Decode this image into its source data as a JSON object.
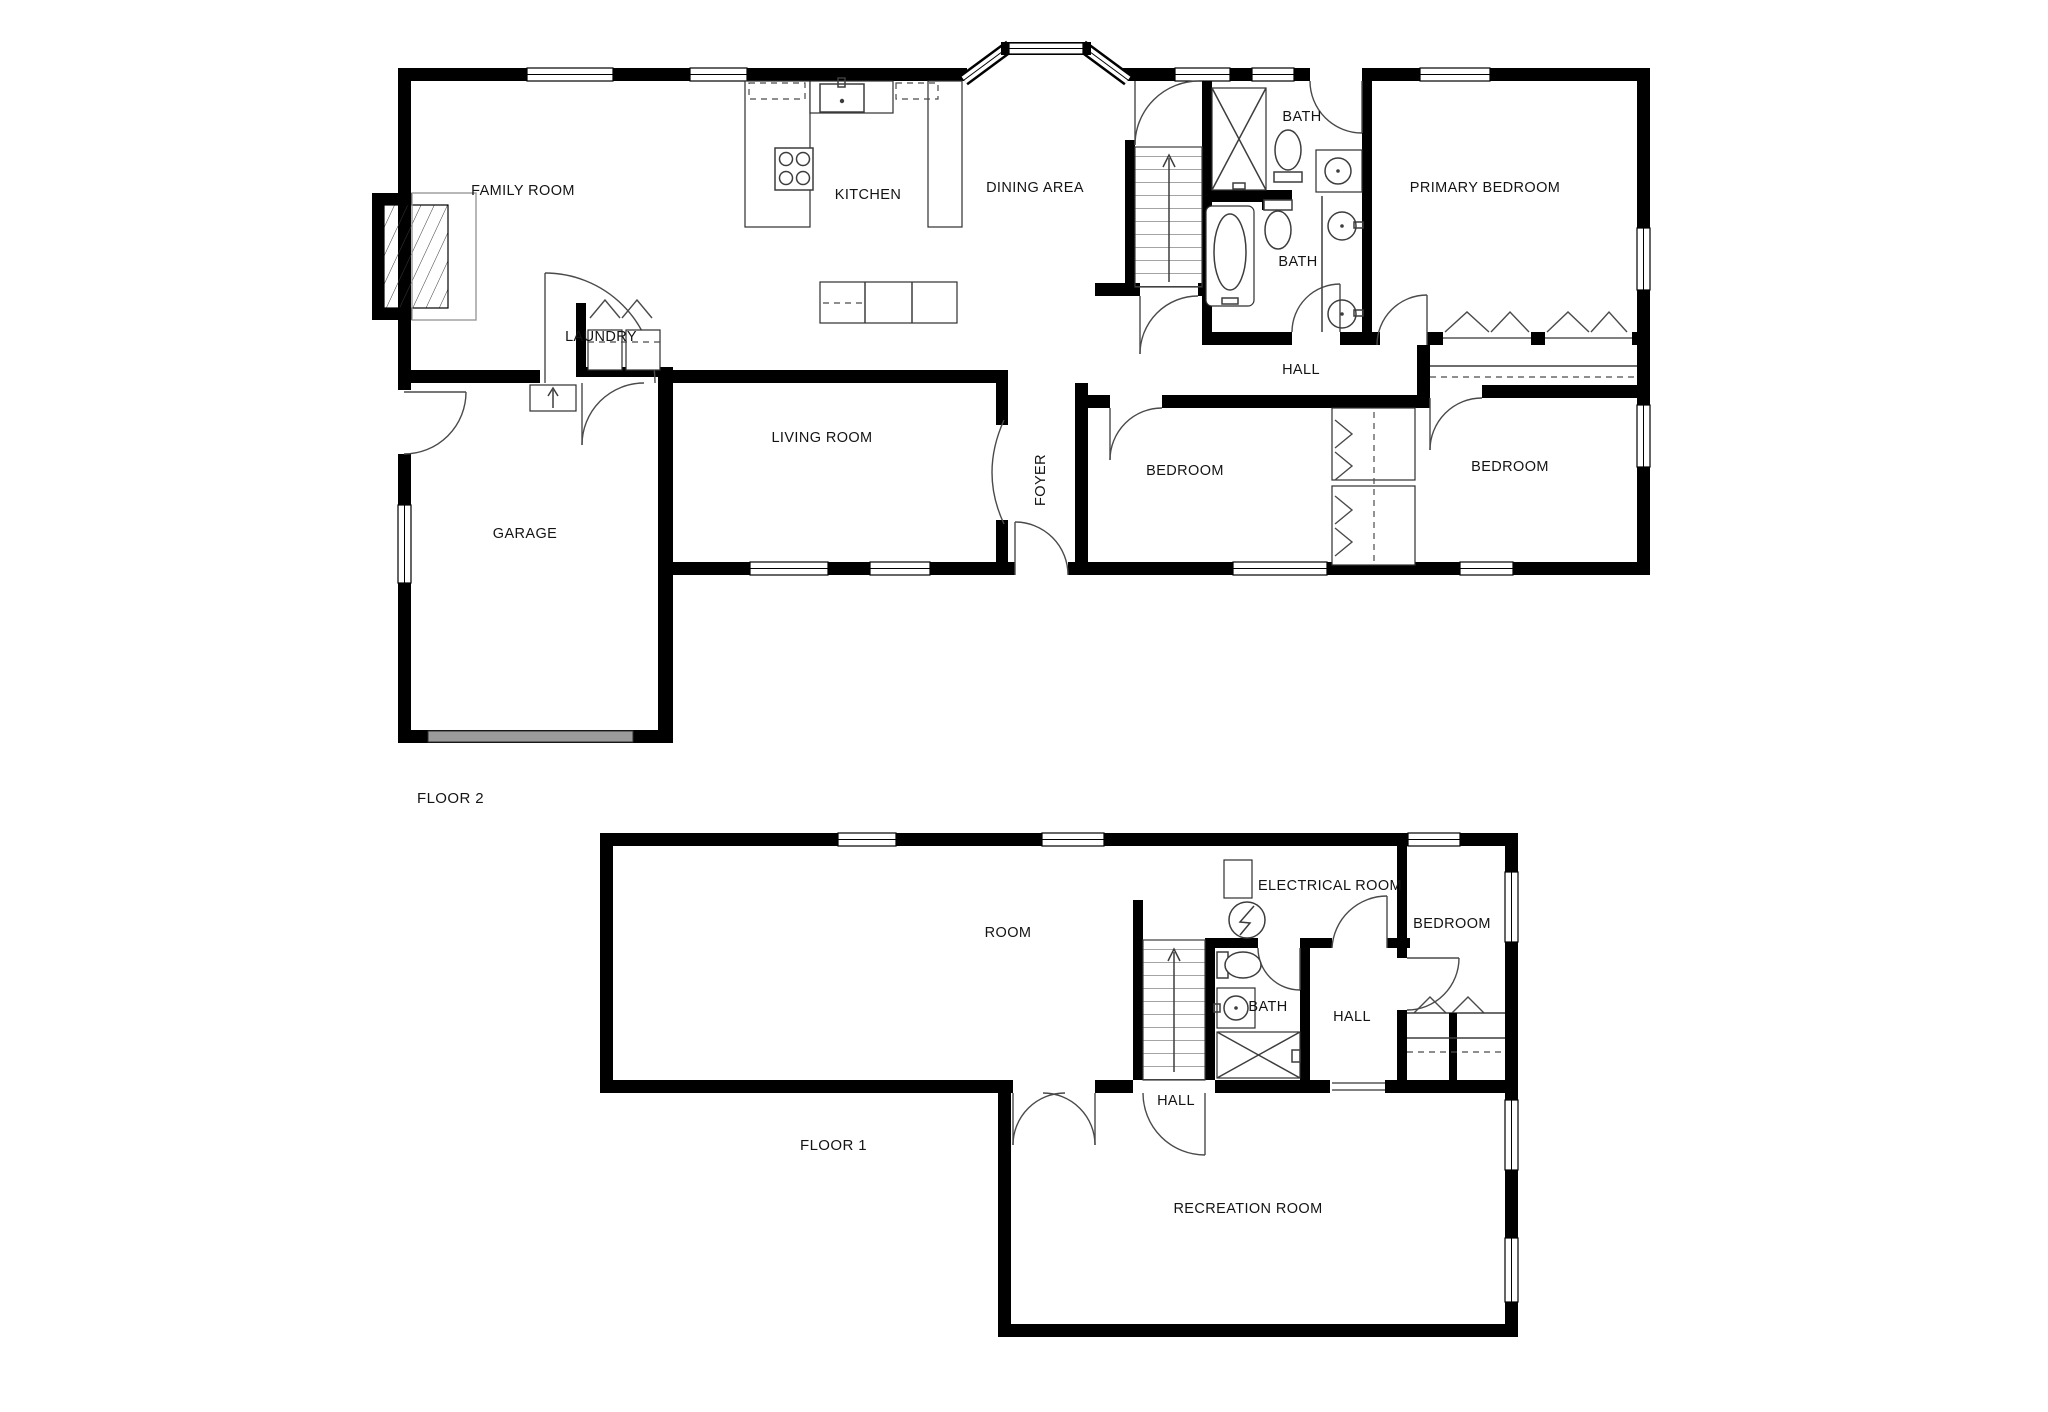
{
  "colors": {
    "background": "#ffffff",
    "wall": "#000000",
    "fixture_line": "#3d3d3d",
    "door_arc": "#4a4a4a",
    "garage_door": "#9b9b9b"
  },
  "floor2": {
    "caption": "FLOOR 2",
    "labels": {
      "family_room": "FAMILY ROOM",
      "kitchen": "KITCHEN",
      "dining_area": "DINING AREA",
      "bath_top": "BATH",
      "bath_bottom": "BATH",
      "primary_bedroom": "PRIMARY BEDROOM",
      "hall": "HALL",
      "laundry": "LAUNDRY",
      "living_room": "LIVING ROOM",
      "foyer": "FOYER",
      "garage": "GARAGE",
      "bedroom_left": "BEDROOM",
      "bedroom_right": "BEDROOM"
    }
  },
  "floor1": {
    "caption": "FLOOR 1",
    "labels": {
      "room": "ROOM",
      "electrical_room": "ELECTRICAL ROOM",
      "bath": "BATH",
      "hall_upper": "HALL",
      "hall_lower": "HALL",
      "bedroom": "BEDROOM",
      "recreation_room": "RECREATION ROOM"
    }
  }
}
